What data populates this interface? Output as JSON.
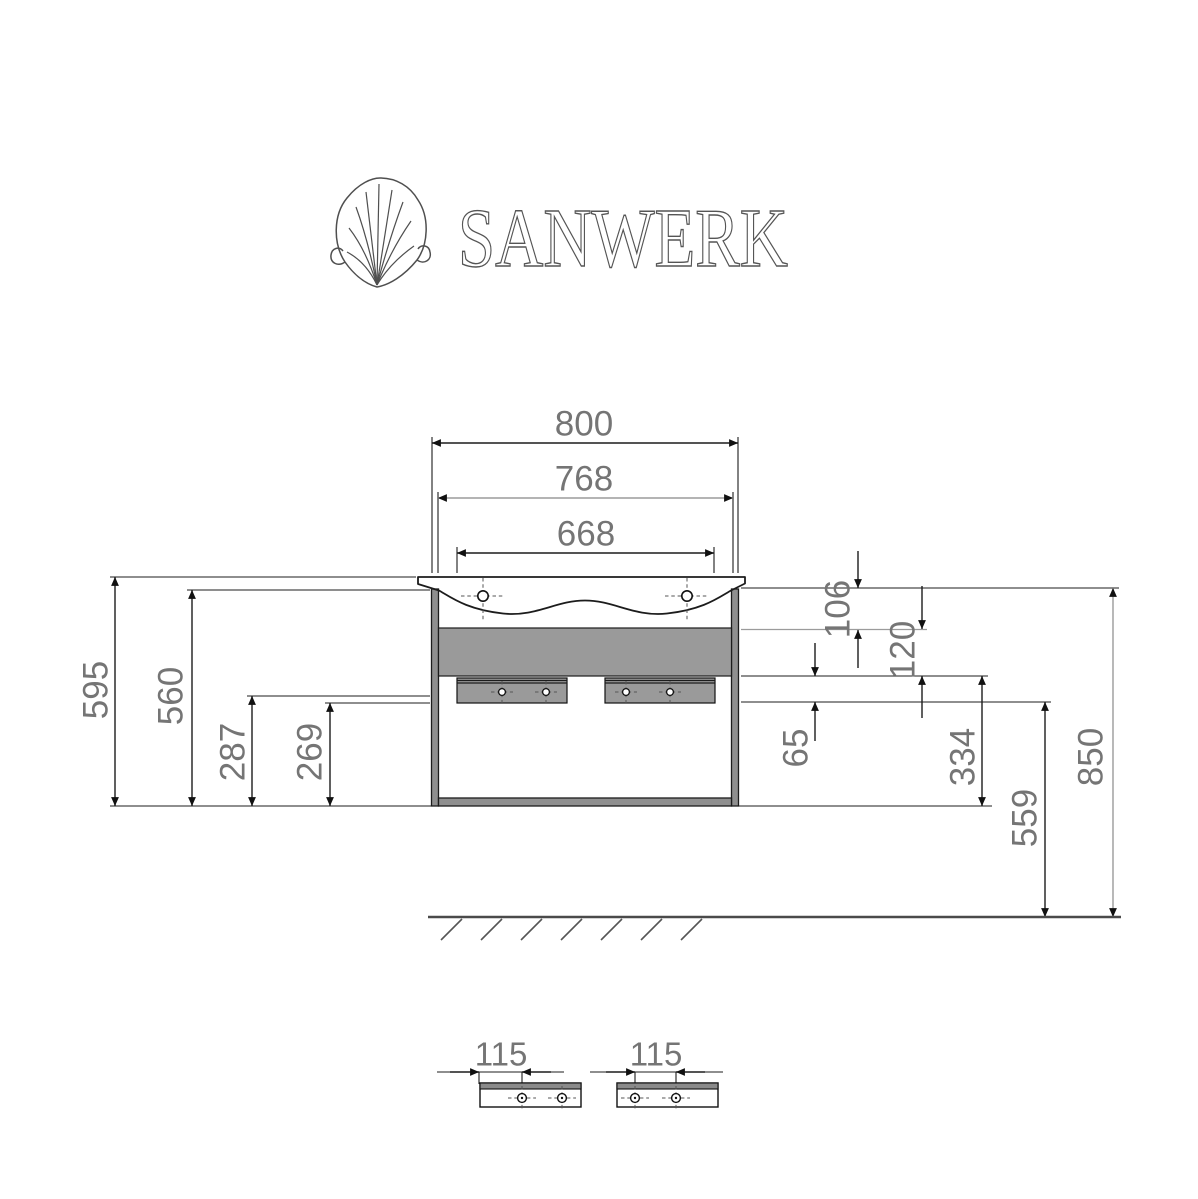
{
  "brand": {
    "name": "SANWERK",
    "icon": "scallop-shell-icon"
  },
  "dimensions": {
    "top": [
      "800",
      "768",
      "668"
    ],
    "left": [
      "595",
      "560",
      "287",
      "269"
    ],
    "right": [
      "106",
      "120",
      "65",
      "334",
      "559",
      "850"
    ],
    "details": [
      "115",
      "115"
    ]
  },
  "colors": {
    "line": "#1c1c1c",
    "dim_text": "#757575",
    "fill_gray": "#9a9a9a",
    "panel_gray": "#8f8f8f",
    "strip_gray": "#8a8a8a",
    "gray_line": "#9b9b9b"
  }
}
